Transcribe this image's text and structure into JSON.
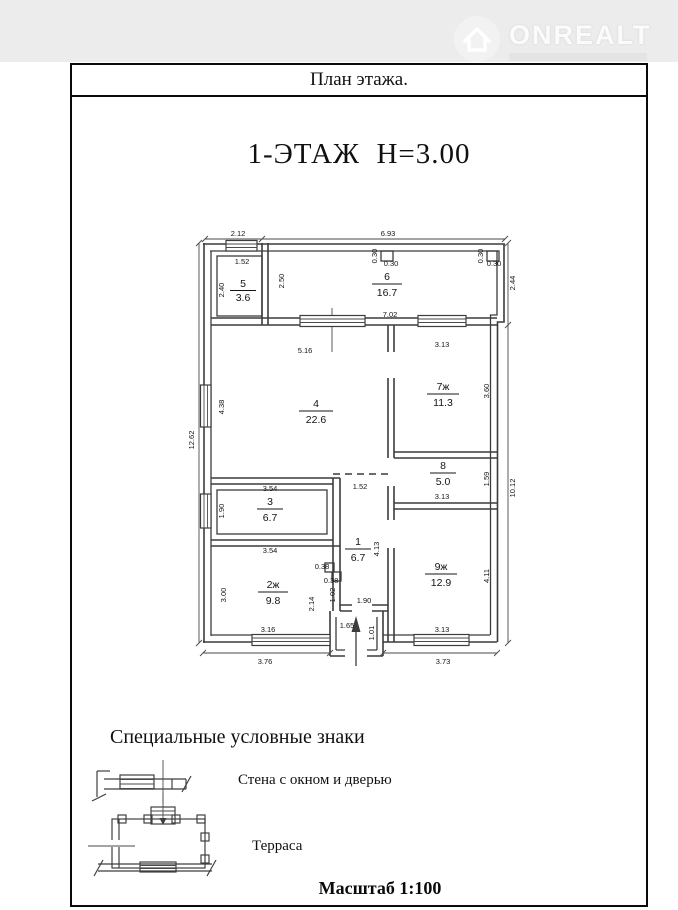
{
  "watermark": {
    "brand": "ONREALT",
    "icon": "house-icon"
  },
  "page": {
    "header_title": "План этажа.",
    "plan_heading": "1-ЭТАЖ  Н=3.00",
    "scale_label": "Масштаб 1:100"
  },
  "plan": {
    "rooms": [
      {
        "number": "5",
        "area": "3.6"
      },
      {
        "number": "6",
        "area": "16.7"
      },
      {
        "number": "4",
        "area": "22.6"
      },
      {
        "number": "7ж",
        "area": "11.3"
      },
      {
        "number": "8",
        "area": "5.0"
      },
      {
        "number": "3",
        "area": "6.7"
      },
      {
        "number": "1",
        "area": "6.7"
      },
      {
        "number": "2ж",
        "area": "9.8"
      },
      {
        "number": "9ж",
        "area": "12.9"
      }
    ],
    "dims": {
      "top_width_left": "2.12",
      "top_width_right": "6.93",
      "room5_width": "1.52",
      "pillar1_h": "0.30",
      "pillar1_w": "0.30",
      "pillar2_h": "0.30",
      "pillar2_w": "0.30",
      "room5_height": "2.40",
      "room6_left_height": "2.50",
      "right_upper_height": "2.44",
      "room6_bottom_width": "7.02",
      "room4_top_width": "5.16",
      "room7_top_width": "3.13",
      "room4_window_height": "4.38",
      "left_total_height": "12.62",
      "room7_right_height": "3.60",
      "right_lower_height": "10.12",
      "room8_right_height": "1.59",
      "room3_top_width": "3.54",
      "hall_opening_width": "1.52",
      "room3_window_height": "1.90",
      "room3_bottom_width": "3.54",
      "hall_height": "4.13",
      "room8_bottom_width": "3.13",
      "wall_step_a": "0.38",
      "wall_step_b": "0.38",
      "wall_step_height": "1.02",
      "room2_right_height": "2.14",
      "hall_bottom_width": "1.90",
      "room2_left_height": "3.00",
      "porch_width": "1.65",
      "porch_height": "1.01",
      "room2_window_width": "3.16",
      "room9_window_width": "3.13",
      "bottom_left_width": "3.76",
      "bottom_right_width": "3.73",
      "room9_right_height": "4.11"
    }
  },
  "legend": {
    "heading": "Специальные условные знаки",
    "items": [
      {
        "symbol": "wall-window-door-symbol",
        "label": "Стена с окном и дверью"
      },
      {
        "symbol": "terrace-symbol",
        "label": "Терраса"
      }
    ]
  }
}
